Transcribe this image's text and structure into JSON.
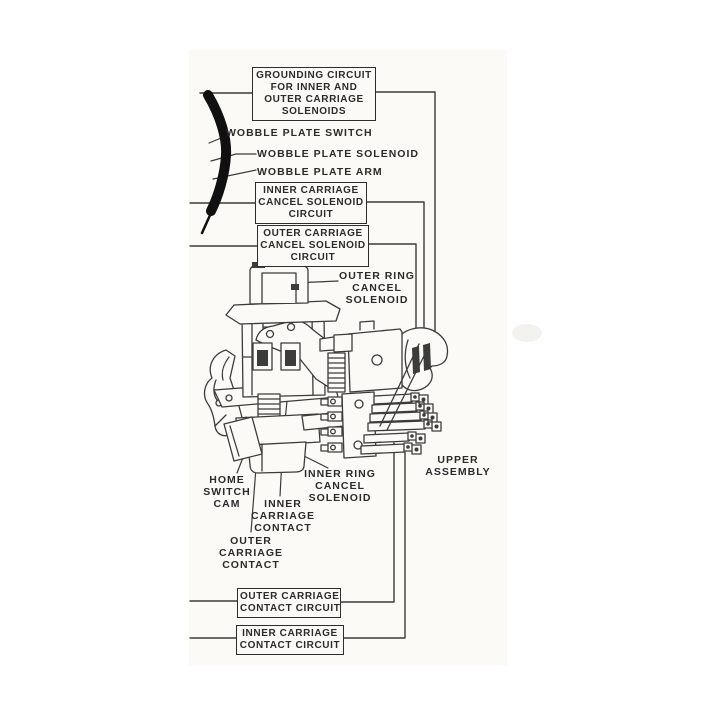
{
  "diagram": {
    "kind": "scanned mechanical line-art diagram of a carriage / wobble-plate solenoid assembly",
    "colors": {
      "ink": "#2e2e2e",
      "paper": "#ffffff",
      "scan_paper": "#fbfaf7",
      "arc_black": "#101010"
    },
    "boxed_labels": {
      "grounding_circuit": [
        "GROUNDING CIRCUIT",
        "FOR INNER AND",
        "OUTER CARRIAGE",
        "SOLENOIDS"
      ],
      "inner_carriage_cancel_solenoid_circuit": [
        "INNER CARRIAGE",
        "CANCEL SOLENOID",
        "CIRCUIT"
      ],
      "outer_carriage_cancel_solenoid_circuit": [
        "OUTER CARRIAGE",
        "CANCEL SOLENOID",
        "CIRCUIT"
      ],
      "outer_carriage_contact_circuit": [
        "OUTER CARRIAGE",
        "CONTACT CIRCUIT"
      ],
      "inner_carriage_contact_circuit": [
        "INNER CARRIAGE",
        "CONTACT CIRCUIT"
      ]
    },
    "callout_labels": {
      "wobble_plate_switch": "WOBBLE PLATE SWITCH",
      "wobble_plate_solenoid": "WOBBLE PLATE SOLENOID",
      "wobble_plate_arm": "WOBBLE PLATE ARM",
      "outer_ring_cancel_solenoid": [
        "OUTER RING",
        "CANCEL",
        "SOLENOID"
      ],
      "home_switch_cam": [
        "HOME",
        "SWITCH",
        "CAM"
      ],
      "inner_ring_cancel_solenoid": [
        "INNER RING",
        "CANCEL",
        "SOLENOID"
      ],
      "inner_carriage_contact": [
        "INNER",
        "CARRIAGE",
        "CONTACT"
      ],
      "outer_carriage_contact": [
        "OUTER",
        "CARRIAGE",
        "CONTACT"
      ],
      "upper_assembly": [
        "UPPER",
        "ASSEMBLY"
      ]
    }
  }
}
